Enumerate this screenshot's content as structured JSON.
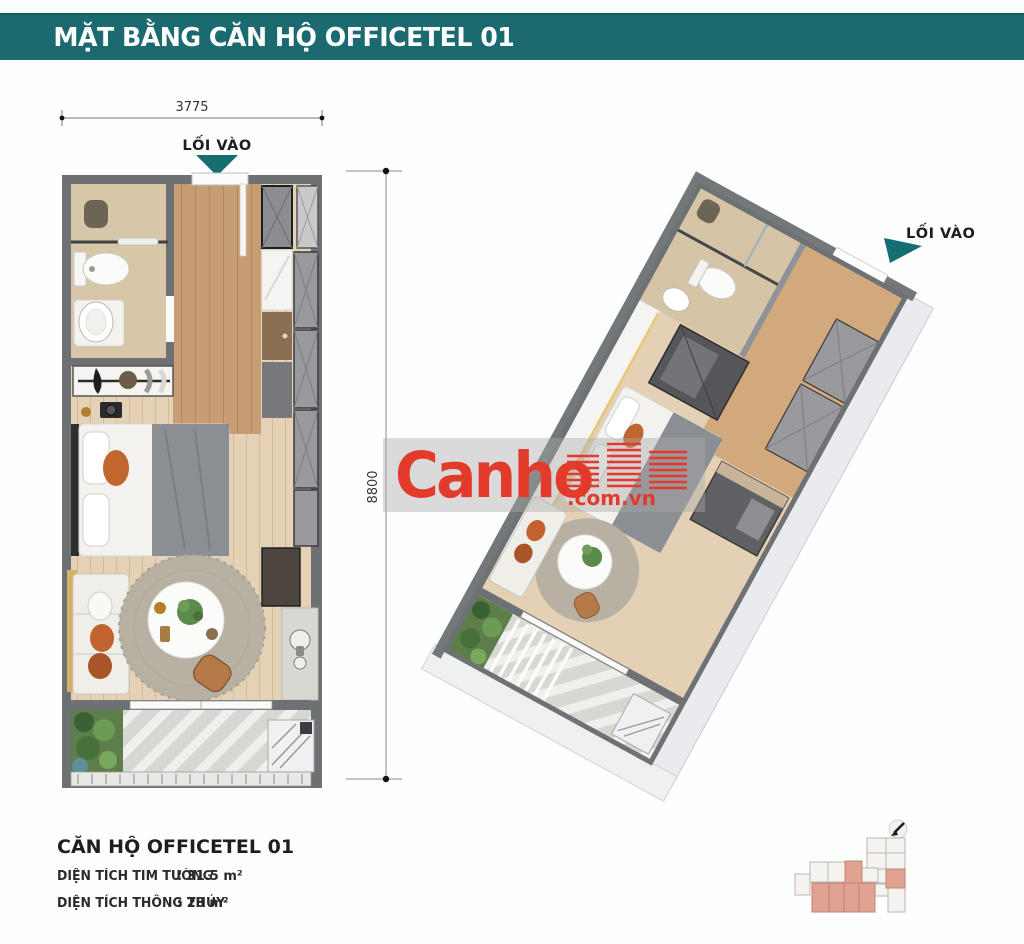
{
  "header": {
    "title": "MẶT BẰNG CĂN HỘ OFFICETEL 01"
  },
  "plan2d": {
    "entrance_label": "LỐI VÀO",
    "width_dim": "3775",
    "height_dim": "8800"
  },
  "plan3d": {
    "entrance_label": "LỐI VÀO"
  },
  "watermark": {
    "brand": "Canho",
    "suffix": ".com.vn",
    "brand_color": "#e23b2c"
  },
  "info": {
    "title": "CĂN HỘ OFFICETEL 01",
    "rows": [
      {
        "label": "DIỆN TÍCH TIM TƯỜNG",
        "value": ": 31.5 m²"
      },
      {
        "label": "DIỆN TÍCH THÔNG THỦY",
        "value": ": 28 m²"
      }
    ]
  },
  "colors": {
    "accent_teal": "#1b6a6f",
    "brand_red": "#e23b2c",
    "highlight_salmon": "#e0a291",
    "wall_gray": "#6e7174"
  }
}
